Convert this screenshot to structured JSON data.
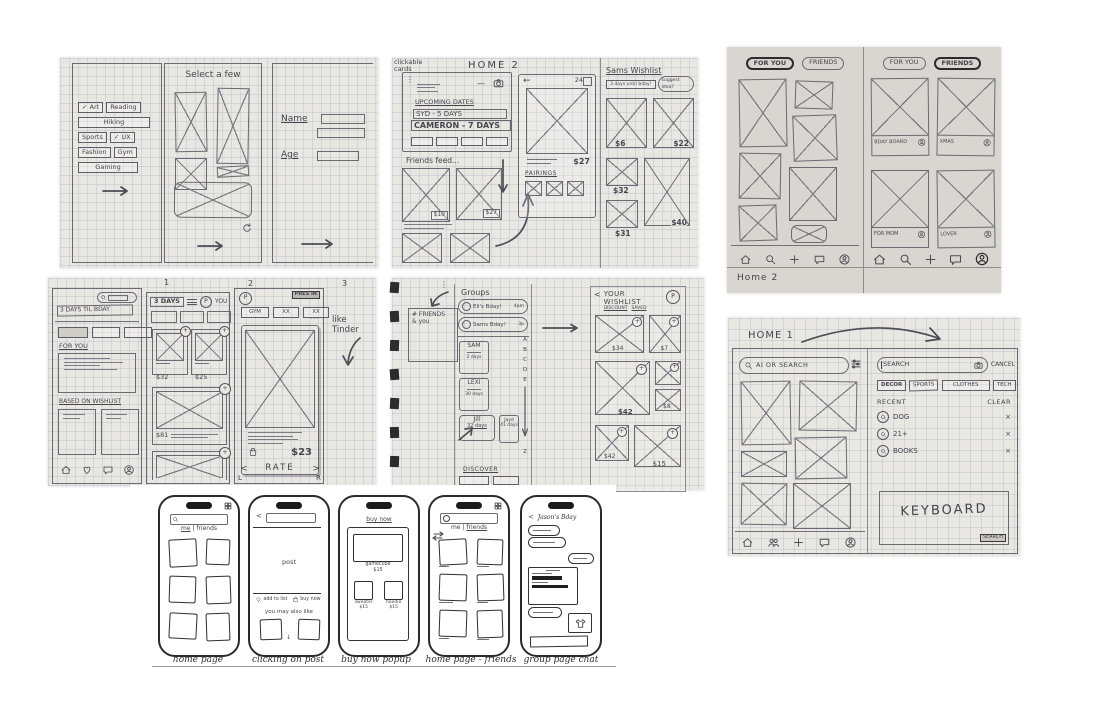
{
  "glyphs": {
    "arrow_right": "→",
    "arrow_left": "←",
    "arrow_down": "↓",
    "check": "✓",
    "close": "×",
    "plus": "+",
    "dots": "⋮",
    "ellipsis": "...",
    "chevron_left": "<",
    "chevron_right": ">",
    "minus": "—",
    "p_badge": "P"
  },
  "onboarding": {
    "title": "Select a few",
    "interests": [
      {
        "label": "Art",
        "check": "✓"
      },
      {
        "label": "Reading"
      },
      {
        "label": "Hiking"
      },
      {
        "label": "Sports"
      },
      {
        "label": "UX",
        "check": "✓"
      },
      {
        "label": "Fashion"
      },
      {
        "label": "Gym"
      },
      {
        "label": "Gaming"
      }
    ],
    "name_label": "Name",
    "age_label": "Age"
  },
  "home2": {
    "note_line1": "clickable",
    "note_line2": "cards",
    "title": "HOME 2",
    "upcoming_title": "UPCOMING DATES",
    "row1": "SYD - 5 DAYS",
    "row2": "CAMERON - 7 DAYS",
    "friends_feed": "Friends feed...",
    "price1": "$10",
    "price2": "$27",
    "detail_count": "24",
    "detail_price": "$27",
    "pairings": "PAIRINGS",
    "wl_title": "Sams Wishlist",
    "wl_sub": "3 days until bday!",
    "wl_pill": "suggest idea?",
    "wl_p1": "$6",
    "wl_p2": "$22",
    "wl_p3": "$32",
    "wl_p4": "$40",
    "wl_p5": "$31"
  },
  "tabs_sketch": {
    "caption": "Home 2",
    "tab_foryou": "FOR YOU",
    "tab_friends": "FRIENDS",
    "boards": [
      "BDAY BOARD",
      "XMAS",
      "FOR MOM",
      "LOVER"
    ]
  },
  "flow": {
    "page1": "1",
    "page2": "2",
    "page3": "3",
    "banner": "3 DAYS TIL BDAY",
    "for_you": "FOR YOU",
    "based_on": "BASED ON WISHLIST",
    "days_pill": "3 DAYS",
    "you": "YOU",
    "p32": "$32",
    "p25": "$25",
    "p81": "$81",
    "pass": "PRES IN",
    "chip1": "GYM",
    "chip2": "XX",
    "chip3": "XX",
    "p23": "$23",
    "rate": "RATE",
    "lkey": "L",
    "rkey": "R",
    "note": "like Tinder"
  },
  "groups": {
    "note1": "# FRIENDS",
    "note2": "& you",
    "title": "Groups",
    "item1": "Eli's Bday!",
    "item1_time": "4pm",
    "item2": "Sams Bday!",
    "item2_time": "3p",
    "letters": [
      "A",
      "B",
      "C",
      "D",
      "E"
    ],
    "letter_end": "Z",
    "f1": "SAM",
    "f1d": "2 days",
    "f2": "LEXI",
    "f2d": "30 days",
    "f3": "Jill",
    "f3d": "32 days",
    "f4": "Jayd",
    "f4d": "41 days",
    "discover": "DISCOVER",
    "wl_title1": "YOUR",
    "wl_title2": "WISHLIST",
    "wl_sub1": "DISCOUNT",
    "wl_sub2": "SAVED",
    "wp1": "$34",
    "wp2": "$7",
    "wp3": "$42",
    "wp4": "$8",
    "wp5": "$42",
    "wp6": "$15"
  },
  "home1": {
    "title": "HOME 1",
    "search_pill": "AI OR SEARCH",
    "search_value": "SEARCH",
    "cancel": "CANCEL",
    "chip1": "DECOR",
    "chip2": "SPORTS",
    "chip3": "CLOTHES",
    "chip4": "TECH",
    "recent": "RECENT",
    "clear": "CLEAR",
    "r1": "DOG",
    "r2": "21+",
    "r3": "BOOKS",
    "keyboard": "KEYBOARD",
    "search_btn": "SEARCH"
  },
  "mockups": {
    "cap1": "home page",
    "cap2": "clicking on post",
    "cap3": "buy now popup",
    "cap4": "home page - friends",
    "cap5": "group page chat",
    "me": "me",
    "friends": "friends",
    "sep": "|",
    "post": "post",
    "add_to_list": "add to list",
    "buy_now": "buy now",
    "you_may_like": "you may also like",
    "popup_title": "buy now",
    "item1": "gamecube",
    "item1p": "$15",
    "item2": "sweater",
    "item2p": "$15",
    "item3": "hoodie",
    "item3p": "$15",
    "chat_title": "Jason's Bday"
  }
}
